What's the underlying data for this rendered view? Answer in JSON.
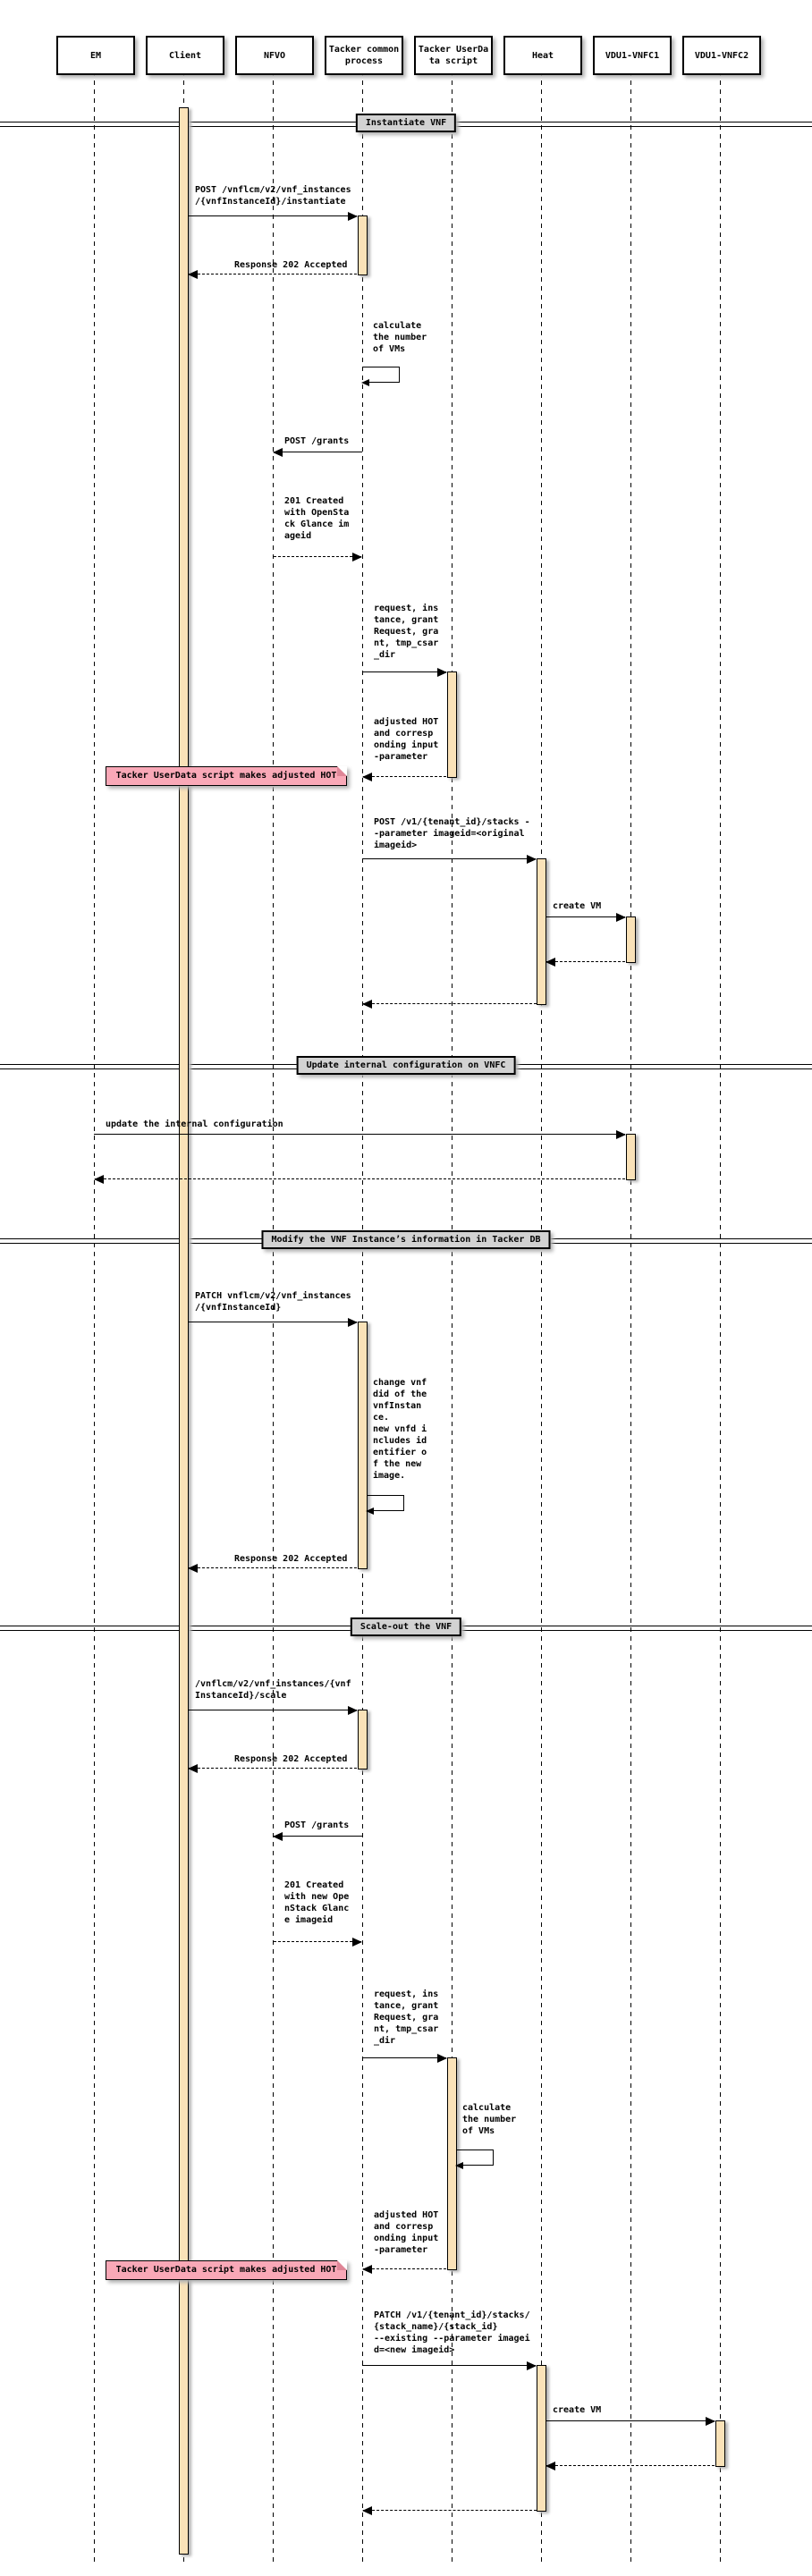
{
  "participants": [
    {
      "label": "EM"
    },
    {
      "label": "Client"
    },
    {
      "label": "NFVO"
    },
    {
      "label": "Tacker common\nprocess"
    },
    {
      "label": "Tacker UserDa\nta script"
    },
    {
      "label": "Heat"
    },
    {
      "label": "VDU1-VNFC1"
    },
    {
      "label": "VDU1-VNFC2"
    }
  ],
  "dividers": [
    {
      "label": "Instantiate VNF"
    },
    {
      "label": "Update internal configuration on VNFC"
    },
    {
      "label": "Modify the VNF Instance’s information in Tacker DB"
    },
    {
      "label": "Scale-out the VNF"
    }
  ],
  "notes": [
    {
      "label": "Tacker UserData script makes adjusted HOT"
    },
    {
      "label": "Tacker UserData script makes adjusted HOT"
    }
  ],
  "messages": {
    "instantiate_post": "POST /vnflcm/v2/vnf_instances\n/{vnfInstanceId}/instantiate",
    "instantiate_response": "Response 202 Accepted",
    "calc_vms_1": "calculate\nthe number\nof VMs",
    "grants_post_1": "POST /grants",
    "grants_created_1": "201 Created\nwith OpenSta\nck Glance im\nageid",
    "userdata_args_1": "request, ins\ntance, grant\nRequest, gra\nnt, tmp_csar\n_dir",
    "adjusted_hot_1": "adjusted HOT\nand corresp\nonding input\n-parameter",
    "stacks_post": "POST /v1/{tenant_id}/stacks -\n-parameter imageid=<original\nimageid>",
    "create_vm_1": "create VM",
    "update_config": "update the internal configuration",
    "patch_vnf": "PATCH vnflcm/v2/vnf_instances\n/{vnfInstanceId}",
    "change_vnfdid": "change vnf\ndid of the\nvnfInstan\nce.\nnew vnfd i\nncludes id\nentifier o\nf the new\nimage.",
    "patch_response": "Response 202 Accepted",
    "scale_post": "/vnflcm/v2/vnf_instances/{vnf\nInstanceId}/scale",
    "scale_response": "Response 202 Accepted",
    "grants_post_2": "POST /grants",
    "grants_created_2": "201 Created\nwith new Ope\nnStack Glanc\ne imageid",
    "userdata_args_2": "request, ins\ntance, grant\nRequest, gra\nnt, tmp_csar\n_dir",
    "calc_vms_2": "calculate\nthe number\nof VMs",
    "adjusted_hot_2": "adjusted HOT\nand corresp\nonding input\n-parameter",
    "stacks_patch": "PATCH /v1/{tenant_id}/stacks/\n{stack_name}/{stack_id}\n--existing --parameter imagei\nd=<new imageid>",
    "create_vm_2": "create VM"
  },
  "colors": {
    "activation": "#FAE2B8",
    "note": "#F9A8B7",
    "divider_bg": "#D2D2D2",
    "line": "#000000"
  }
}
